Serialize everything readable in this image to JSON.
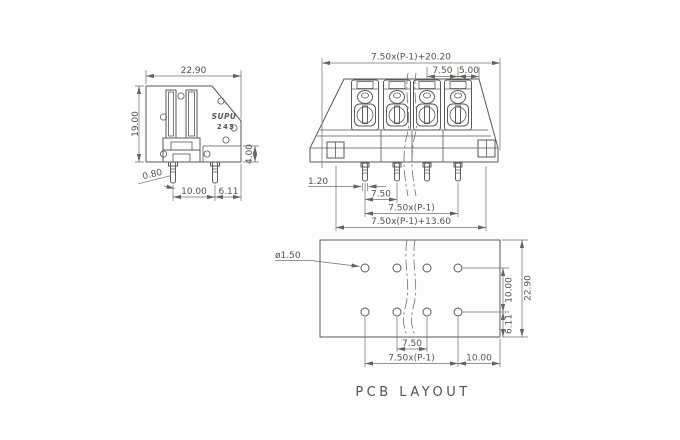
{
  "page": {
    "caption": "PCB LAYOUT"
  },
  "component": {
    "brand": "SUPU",
    "model": "245"
  },
  "side_view": {
    "width": "22.90",
    "height": "19.00",
    "pin_width": "0.80",
    "pin_spacing": "10.00",
    "pin_to_edge": "6.11",
    "step_height": "4.00"
  },
  "front_view": {
    "overall_width": "7.50x(P-1)+20.20",
    "pitch": "7.50",
    "end_margin": "5.00",
    "pin_width": "1.20",
    "pin_pitch": "7.50",
    "pin_span": "7.50x(P-1)",
    "mount_span": "7.50x(P-1)+13.60"
  },
  "pcb_layout": {
    "hole_diameter": "ø1.50",
    "row_spacing": "10.00",
    "board_height": "22.90",
    "row_to_edge": "6.11",
    "hole_pitch": "7.50",
    "hole_span": "7.50x(P-1)",
    "edge_margin": "10.00"
  }
}
